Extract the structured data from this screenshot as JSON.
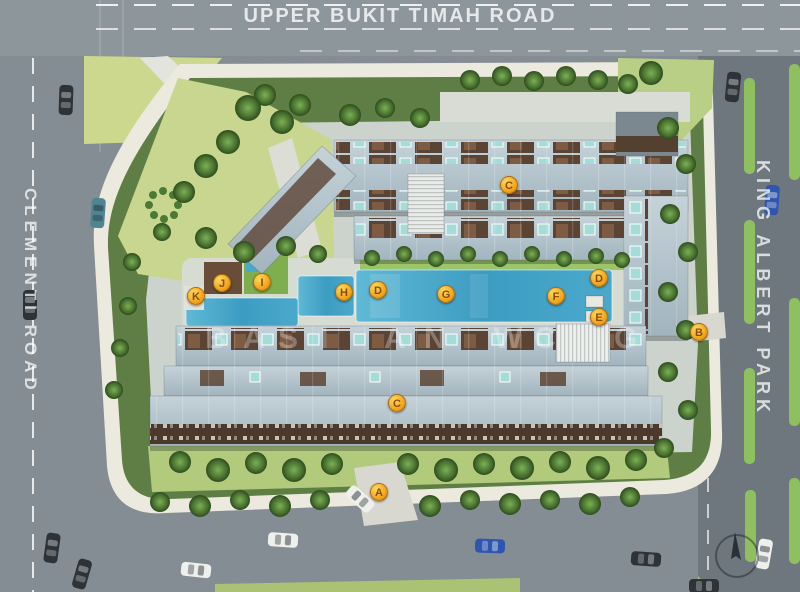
{
  "plan": {
    "type": "condominium-site-plan",
    "roads": {
      "top": "UPPER BUKIT TIMAH ROAD",
      "left": "CLEMENTI ROAD",
      "right": "KING ALBERT PARK"
    },
    "markers": [
      {
        "label": "A",
        "position": "bottom-entrance"
      },
      {
        "label": "B",
        "position": "east-side-gate"
      },
      {
        "label": "C",
        "position": "north-block-roof"
      },
      {
        "label": "C",
        "position": "south-block-roof"
      },
      {
        "label": "D",
        "position": "pool-west"
      },
      {
        "label": "D",
        "position": "pool-east-top"
      },
      {
        "label": "E",
        "position": "pool-east-bottom"
      },
      {
        "label": "F",
        "position": "pool-mid-east"
      },
      {
        "label": "G",
        "position": "pool-mid-west"
      },
      {
        "label": "H",
        "position": "small-pool"
      },
      {
        "label": "I",
        "position": "clubhouse"
      },
      {
        "label": "J",
        "position": "west-deck"
      },
      {
        "label": "K",
        "position": "west-water-feature"
      }
    ],
    "watermark": {
      "letters": [
        "B",
        "A",
        "S",
        "I",
        "A",
        "N",
        "W",
        "C",
        "G"
      ]
    },
    "palette": {
      "road_gray": "#848d93",
      "right_road_gray": "#6e777d",
      "sidewalk": "#eceade",
      "vegetation_dark": "#5f7e45",
      "lawn_light": "#c8d68f",
      "median_green": "#8fbf5e",
      "roof_gray_blue": "#b0c0c9",
      "roof_brown": "#5c4434",
      "pool_blue": "#3d9cc2",
      "plunge_cyan": "#a6dcd7",
      "marker_orange": "#f2a71d",
      "lane_marking": "#ffffff"
    }
  }
}
